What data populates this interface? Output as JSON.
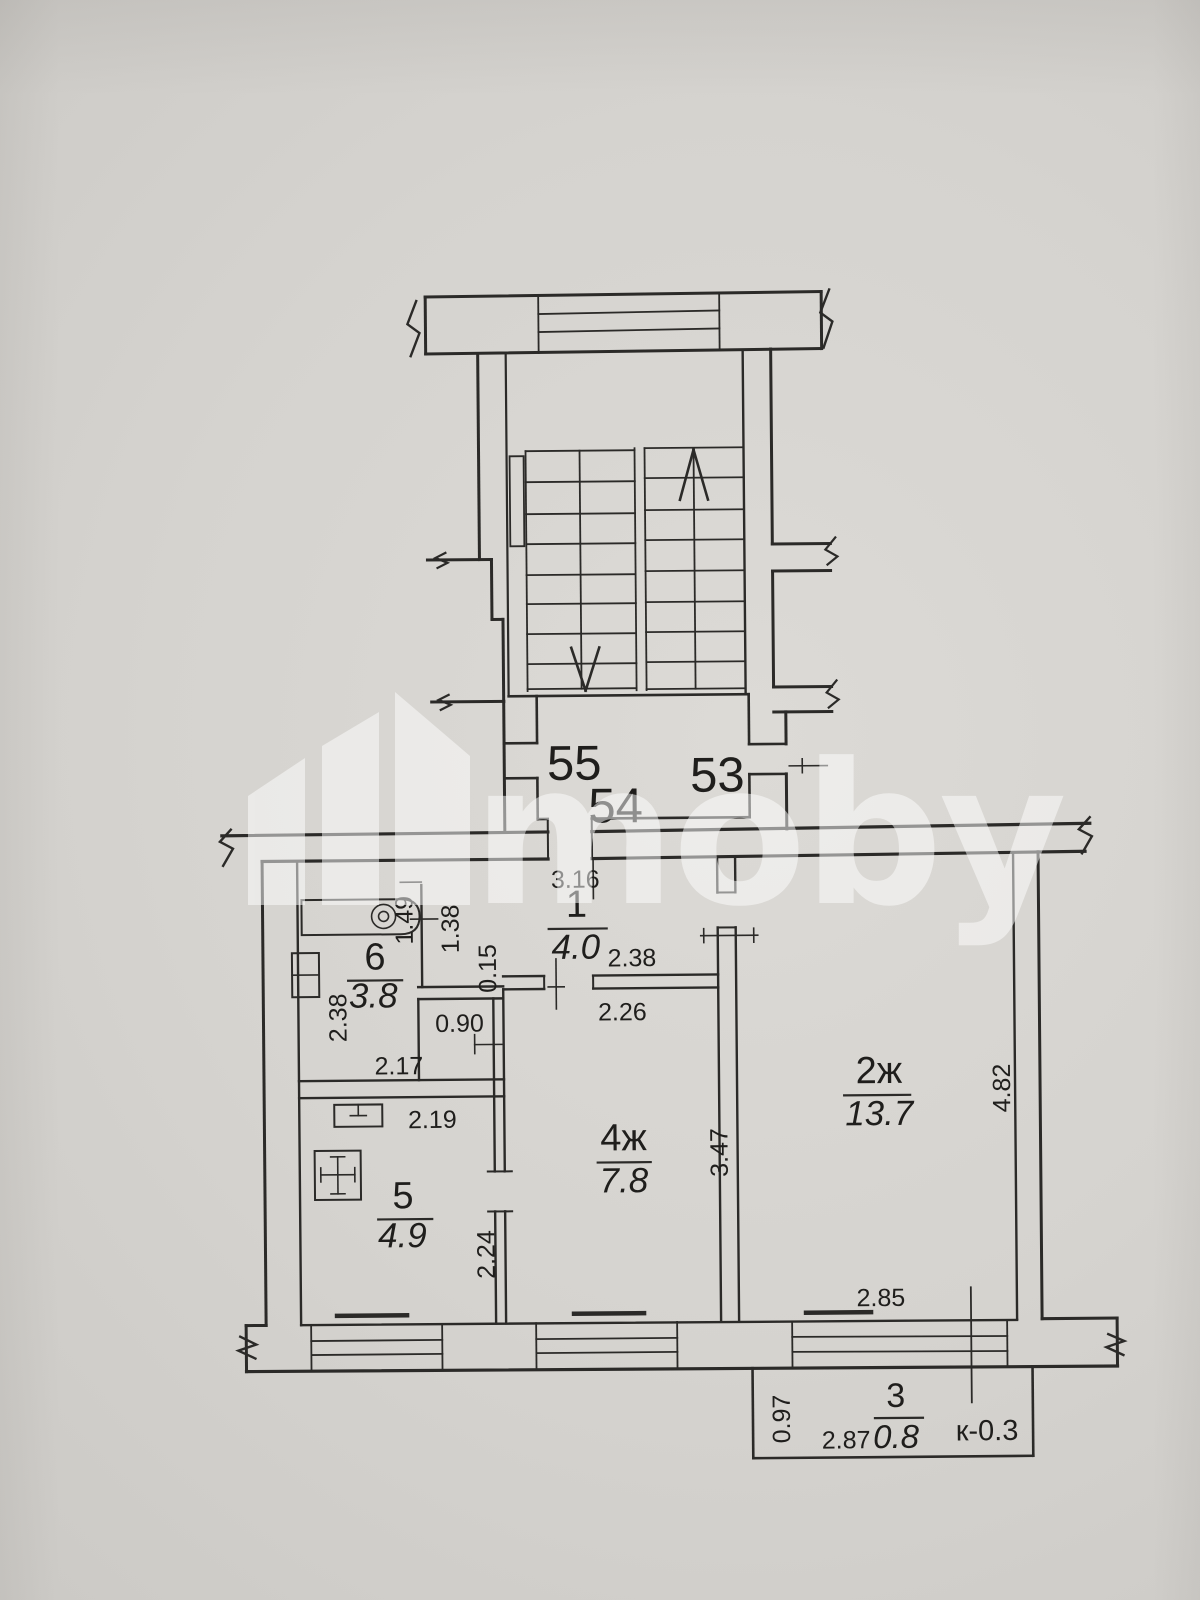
{
  "watermark": {
    "text": "moby"
  },
  "colors": {
    "paper": "#d5d3cf",
    "ink": "#2b2a28"
  },
  "apartment_numbers": {
    "apt_left": "55",
    "apt_middle": "54",
    "apt_right": "53"
  },
  "rooms": {
    "hallway": {
      "number": "1",
      "area": "4.0"
    },
    "living_room": {
      "number": "2ж",
      "area": "13.7"
    },
    "balcony": {
      "number": "3",
      "area": "0.8",
      "coefficient": "к-0.3"
    },
    "bedroom": {
      "number": "4ж",
      "area": "7.8"
    },
    "kitchen": {
      "number": "5",
      "area": "4.9"
    },
    "bathroom": {
      "number": "6",
      "area": "3.8"
    }
  },
  "dimensions": {
    "hall_width_top": "3.16",
    "hall_width_right": "2.38",
    "bedroom_width_top": "2.26",
    "bath_recess_depth": "1.49",
    "bath_wall_right": "1.38",
    "wall_ledge": "0.15",
    "duct_width": "0.90",
    "bath_width_bottom": "2.17",
    "bath_height_left": "2.38",
    "kitchen_width_top": "2.19",
    "kitchen_height_right": "2.24",
    "bedroom_height_right": "3.47",
    "living_height_right": "4.82",
    "living_window_width": "2.85",
    "balcony_depth_left": "0.97",
    "balcony_width_bottom": "2.87"
  }
}
